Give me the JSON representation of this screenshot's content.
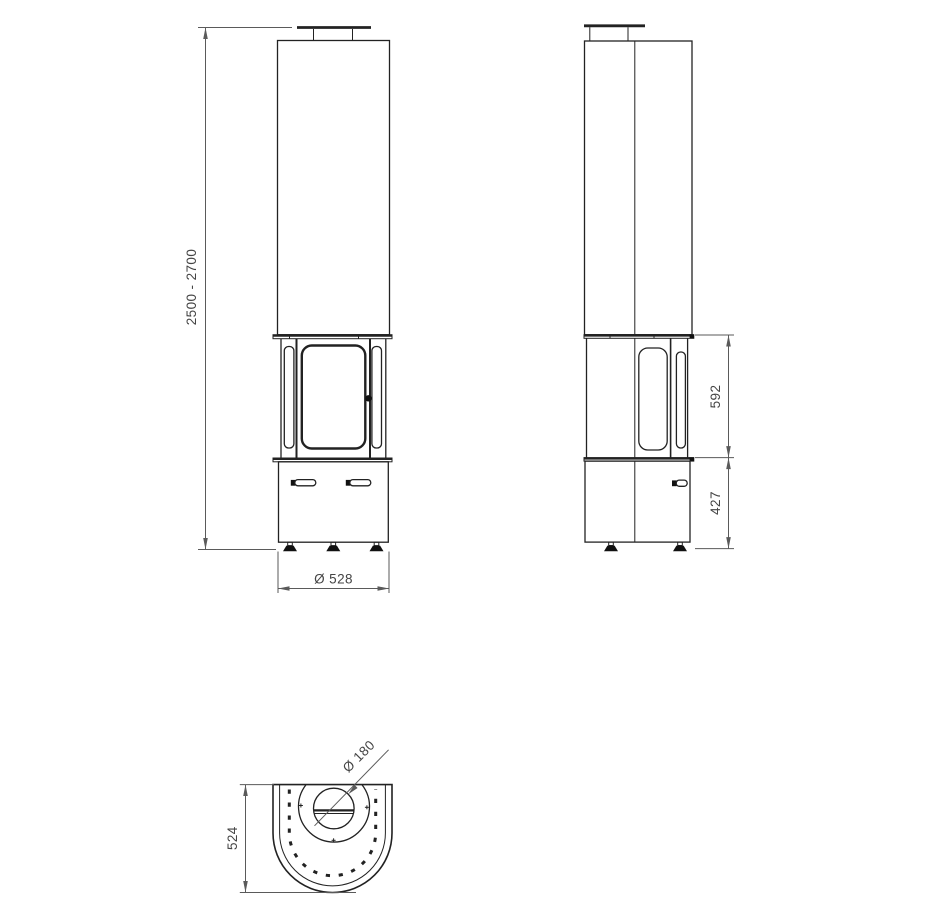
{
  "colors": {
    "background": "#ffffff",
    "part_line": "#222222",
    "dim_line": "#5a5a5a",
    "dim_text": "#454545",
    "fill_black": "#111111"
  },
  "dimensions": {
    "front_height": "2500 - 2700",
    "front_diameter": "Ø 528",
    "side_firebox_height": "592",
    "side_base_height": "427",
    "top_depth": "524",
    "top_flue_diameter": "Ø 180"
  }
}
